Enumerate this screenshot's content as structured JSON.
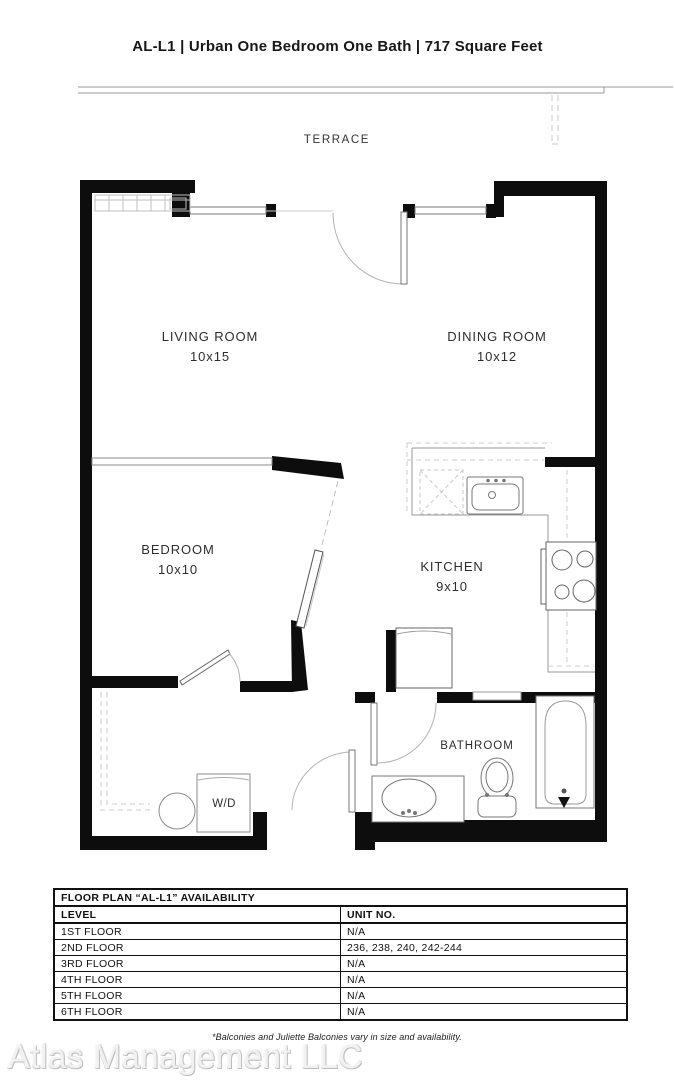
{
  "page": {
    "title": "AL-L1 | Urban One Bedroom One Bath | 717 Square Feet",
    "footnote": "*Balconies and Juliette Balconies vary in size and availability.",
    "watermark": "Atlas Management LLC"
  },
  "floor_plan": {
    "terrace_label": "TERRACE",
    "living_room": {
      "name": "LIVING ROOM",
      "dims": "10x15"
    },
    "dining_room": {
      "name": "DINING ROOM",
      "dims": "10x12"
    },
    "bedroom": {
      "name": "BEDROOM",
      "dims": "10x10"
    },
    "kitchen": {
      "name": "KITCHEN",
      "dims": "9x10"
    },
    "bathroom_label": "BATHROOM",
    "washer_dryer_label": "W/D"
  },
  "availability_table": {
    "title": "FLOOR PLAN “AL-L1” AVAILABILITY",
    "columns": [
      "LEVEL",
      "UNIT NO."
    ],
    "rows": [
      {
        "level": "1ST FLOOR",
        "units": "N/A"
      },
      {
        "level": "2ND FLOOR",
        "units": "236, 238, 240, 242-244"
      },
      {
        "level": "3RD FLOOR",
        "units": "N/A"
      },
      {
        "level": "4TH FLOOR",
        "units": "N/A"
      },
      {
        "level": "5TH FLOOR",
        "units": "N/A"
      },
      {
        "level": "6TH FLOOR",
        "units": "N/A"
      }
    ]
  },
  "colors": {
    "wall": "#0d0d0d",
    "fixture_line": "#8c8c8c",
    "dashed_line": "#c4c4c4",
    "text": "#171717",
    "watermark": "#e6e6e6"
  }
}
